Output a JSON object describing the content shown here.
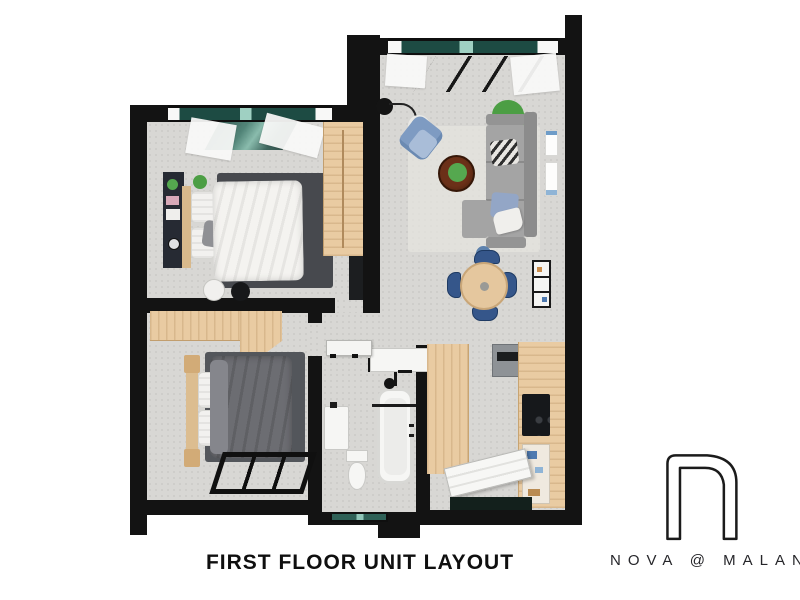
{
  "caption": {
    "text": "FIRST FLOOR UNIT LAYOUT"
  },
  "brand": {
    "name": "NOVA @ MALAN",
    "logo": "n-monogram-outline"
  },
  "palette": {
    "wall": "#131313",
    "floor_gray": "#d8d7d4",
    "wood": "#e9cba2",
    "glass_teal": "#2e5f55",
    "sofa_gray": "#a4a4a4",
    "accent_blue": "#7e9bc2",
    "chair_navy": "#35568a",
    "rug_dark": "#47494e",
    "coffee_table_brown": "#5c2d1a",
    "plant_green": "#55a84f",
    "bedding_white": "#f4f3f0",
    "bedding_gray": "#6c6d72"
  },
  "rooms": {
    "bedroom_main": {
      "furniture": [
        "double-bed",
        "dark-rug",
        "wall-shelf-unit",
        "wardrobe",
        "side-tables",
        "plant",
        "curtained-window"
      ]
    },
    "living_dining": {
      "furniture": [
        "l-shaped-sofa",
        "chevron-pillow",
        "blue-pillow",
        "coffee-table",
        "armchair",
        "floor-lamp",
        "side-table",
        "plants",
        "wall-art",
        "dining-table",
        "dining-chairs-x4",
        "wall-shelf",
        "curtained-window"
      ]
    },
    "kitchen_entry": {
      "furniture": [
        "counter-left",
        "counter-right",
        "appliance-column",
        "cooktop",
        "open-shelf",
        "entry-door",
        "threshold"
      ]
    },
    "bathroom": {
      "furniture": [
        "bathtub",
        "shower-head",
        "toilet",
        "vanity-basin",
        "window"
      ]
    },
    "bedroom_second": {
      "furniture": [
        "double-bed",
        "dark-rug",
        "wardrobe",
        "headboard",
        "floor-window"
      ]
    },
    "hallway": {
      "furniture": [
        "open-door-leaf"
      ]
    }
  }
}
